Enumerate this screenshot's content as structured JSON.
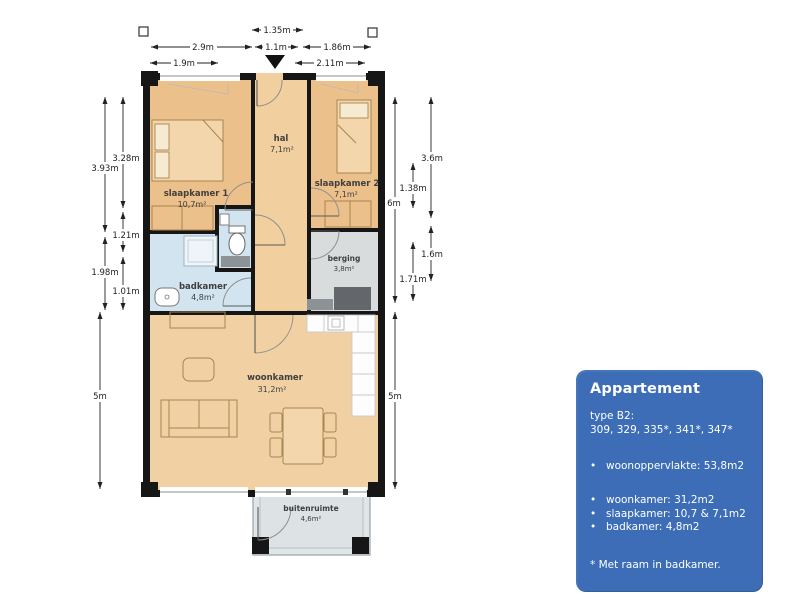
{
  "plan": {
    "rooms": {
      "slaapkamer1": {
        "name": "slaapkamer 1",
        "area": "10,7m²"
      },
      "hal": {
        "name": "hal",
        "area": "7,1m²"
      },
      "slaapkamer2": {
        "name": "slaapkamer 2",
        "area": "7,1m²"
      },
      "badkamer": {
        "name": "badkamer",
        "area": "4,8m²"
      },
      "berging": {
        "name": "berging",
        "area": "3,8m²"
      },
      "woonkamer": {
        "name": "woonkamer",
        "area": "31,2m²"
      },
      "buitenruimte": {
        "name": "buitenruimte",
        "area": "4,6m²"
      }
    },
    "dimensions": {
      "top": {
        "w135": "1.35m",
        "w29": "2.9m",
        "w11": "1.1m",
        "w186": "1.86m",
        "w19": "1.9m",
        "w211": "2.11m"
      },
      "left": {
        "h328": "3.28m",
        "h393": "3.93m",
        "h121": "1.21m",
        "h198": "1.98m",
        "h101": "1.01m",
        "h5": "5m"
      },
      "right": {
        "h36": "3.6m",
        "h138": "1.38m",
        "h6": "6m",
        "h16": "1.6m",
        "h171": "1.71m",
        "h5": "5m"
      }
    }
  },
  "info_box": {
    "title": "Appartement",
    "type_label": "type B2:",
    "unit_numbers": "309, 329, 335*, 341*, 347*",
    "bullet_primary": "woonoppervlakte: 53,8m2",
    "bullets": [
      "woonkamer: 31,2m2",
      "slaapkamer: 10,7 & 7,1m2",
      "badkamer: 4,8m2"
    ],
    "footnote": "* Met raam in badkamer."
  },
  "colors": {
    "wall": "#161616",
    "bedroom_fill": "#ecc08b",
    "hal_fill": "#f2cf9f",
    "living_fill": "#f1d1a4",
    "bath_fill": "#d2e4ef",
    "storage_fill": "#d9dcdd",
    "balcony_fill": "#e0e5e8",
    "info_box_bg": "#3c6db6",
    "info_box_text": "#ffffff"
  }
}
